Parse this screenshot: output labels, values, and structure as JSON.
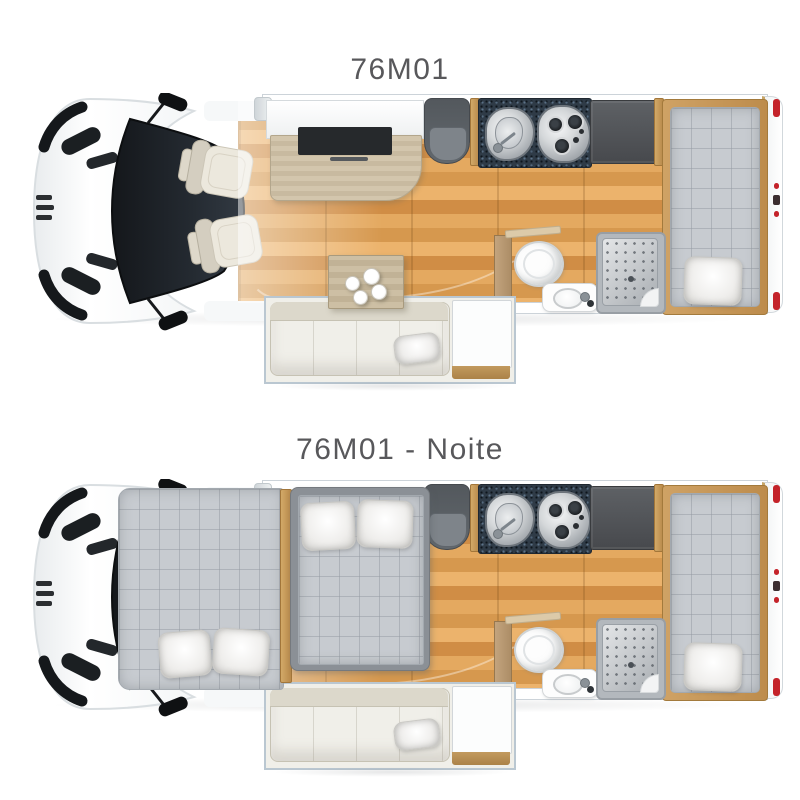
{
  "page": {
    "background_color": "#ffffff",
    "content": "Motorhome model 76M01 floor plans, day and night configurations, top-down view"
  },
  "plans": [
    {
      "id": "day",
      "title": "76M01",
      "mode": "day",
      "features": [
        "cab",
        "side-mirror-top",
        "side-mirror-bottom",
        "swivel-captain-seat-left",
        "swivel-captain-seat-right",
        "tv-counter",
        "tv-cabinet",
        "dinette-table",
        "coffee-cups",
        "front-facing-seat",
        "kitchen-sink",
        "three-burner-hob",
        "refrigerator",
        "toilet",
        "washbasin",
        "shower",
        "slide-out",
        "sofa",
        "sofa-pillow",
        "side-cabinet",
        "rear-single-bed",
        "rear-bed-pillow"
      ]
    },
    {
      "id": "night",
      "title": "76M01 - Noite",
      "mode": "night",
      "features": [
        "cab",
        "side-mirror-top",
        "side-mirror-bottom",
        "over-cab-double-bed",
        "over-cab-pillow-left",
        "over-cab-pillow-right",
        "main-double-bed",
        "main-bed-pillow-left",
        "main-bed-pillow-right",
        "front-facing-seat",
        "kitchen-sink",
        "three-burner-hob",
        "refrigerator",
        "toilet",
        "washbasin",
        "shower",
        "slide-out",
        "sofa",
        "sofa-pillow",
        "side-cabinet",
        "rear-single-bed",
        "rear-bed-pillow"
      ]
    }
  ],
  "colors": {
    "title_text": "#58585b",
    "floor_wood": "#dfa35c",
    "wood_trim": "#c39a5d",
    "mattress_gray": "#c7cbd0",
    "mattress_frame_gray": "#8b9096",
    "counter_granite": "#2f3b47",
    "stainless_steel": "#c9cccf",
    "dark_cabinet": "#55585c",
    "seat_cream": "#e9e5da",
    "sofa_cream": "#e6e3d7",
    "gray_seat": "#6a7075",
    "shower_tray": "#b3b8bd",
    "fixture_white": "#fdfdfd",
    "tail_light_red": "#c4232a",
    "cab_body_white": "#fbfcfc",
    "windshield_dark": "#1d2126",
    "slideout_frame_blue": "#bac7d1"
  }
}
